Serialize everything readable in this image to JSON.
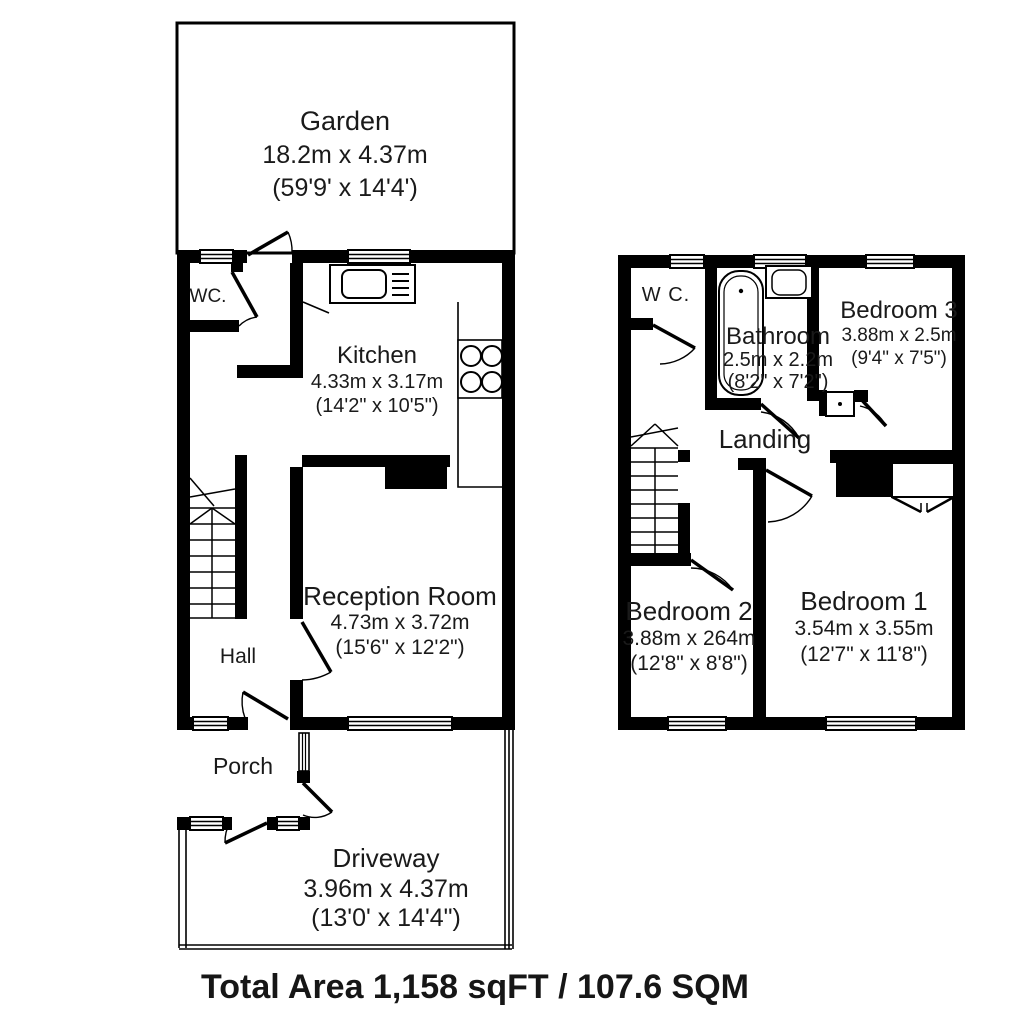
{
  "footer": {
    "total_area": "Total Area 1,158 sqFT / 107.6 SQM"
  },
  "colors": {
    "wall": "#000000",
    "background": "#ffffff",
    "line": "#000000"
  },
  "floors": [
    {
      "id": "ground-floor",
      "rooms": [
        {
          "name": "Garden",
          "metric": "18.2m x 4.37m",
          "imperial": "(59'9' x 14'4')"
        },
        {
          "name": "WC."
        },
        {
          "name": "Kitchen",
          "metric": "4.33m x 3.17m",
          "imperial": "(14'2\" x 10'5\")"
        },
        {
          "name": "Reception Room",
          "metric": "4.73m x 3.72m",
          "imperial": "(15'6\" x 12'2\")"
        },
        {
          "name": "Hall"
        },
        {
          "name": "Porch"
        },
        {
          "name": "Driveway",
          "metric": "3.96m x 4.37m",
          "imperial": "(13'0' x 14'4\")"
        }
      ]
    },
    {
      "id": "first-floor",
      "rooms": [
        {
          "name": "W C."
        },
        {
          "name": "Bathroom",
          "metric": "2.5m x 2.2m",
          "imperial": "(8'2\" x 7'2\")"
        },
        {
          "name": "Bedroom 3",
          "metric": "3.88m x 2.5m",
          "imperial": "(9'4\" x 7'5\")"
        },
        {
          "name": "Landing"
        },
        {
          "name": "Bedroom 2",
          "metric": "3.88m x 264m",
          "imperial": "(12'8\" x 8'8\")"
        },
        {
          "name": "Bedroom 1",
          "metric": "3.54m x 3.55m",
          "imperial": "(12'7\" x 11'8\")"
        }
      ]
    }
  ]
}
